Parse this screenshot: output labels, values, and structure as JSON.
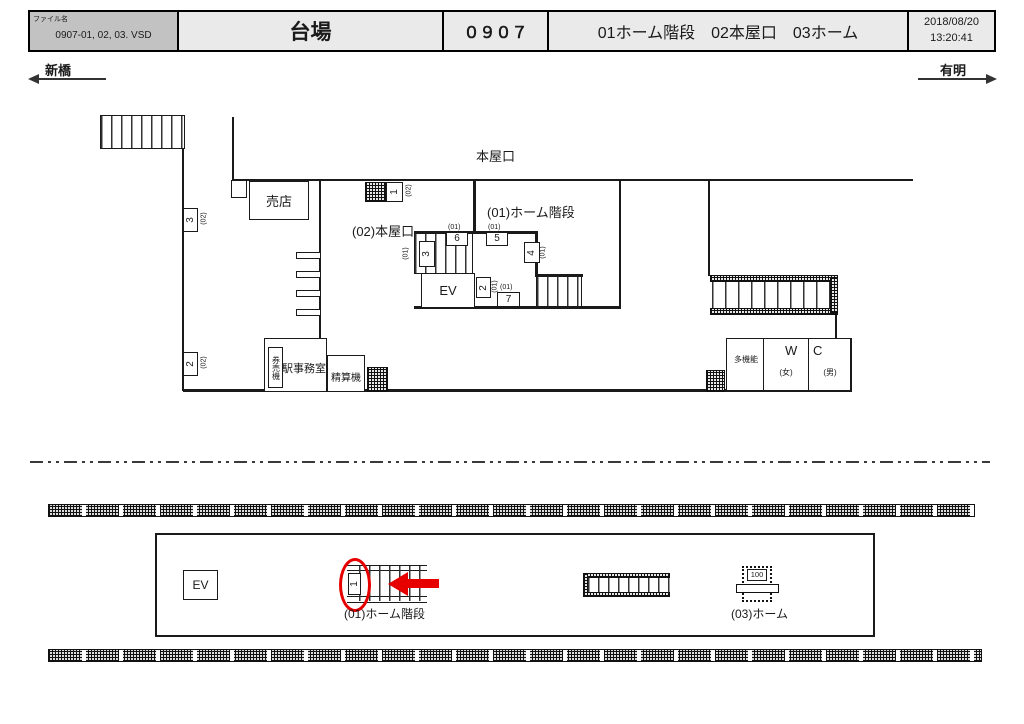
{
  "header": {
    "file_label": "ファイル名",
    "file_value": "0907-01, 02, 03. VSD",
    "station": "台場",
    "code": "０９０７",
    "subtitle": "01ホーム階段　02本屋口　03ホーム",
    "date": "2018/08/20",
    "time": "13:20:41"
  },
  "directions": {
    "left": "新橋",
    "right": "有明"
  },
  "concourse": {
    "honyaguchi": "本屋口",
    "baiten": "売店",
    "entrance02": "(02)本屋口",
    "stairs01": "(01)ホーム階段",
    "ev": "EV",
    "kenbaiki": "券売機",
    "office": "駅事務室",
    "seisanki": "精算機",
    "takinou": "多機能",
    "wc_w": "W",
    "wc_c": "C",
    "female": "(女)",
    "male": "(男)",
    "markers": {
      "m3_02": {
        "num": "3",
        "sub": "(02)"
      },
      "m2_02": {
        "num": "2",
        "sub": "(02)"
      },
      "m1_02": {
        "num": "1",
        "sub": "(02)"
      },
      "m3_01": {
        "num": "3",
        "sub": "(01)"
      },
      "m6_01": {
        "num": "6",
        "sub": "(01)"
      },
      "m5_01": {
        "num": "5",
        "sub": "(01)"
      },
      "m4_01": {
        "num": "4",
        "sub": "(01)"
      },
      "m2_01": {
        "num": "2",
        "sub": "(01)"
      },
      "m7_01": {
        "num": "7",
        "sub": "(01)"
      }
    }
  },
  "platform": {
    "ev": "EV",
    "marker1": "1",
    "stairs01": "(01)ホーム階段",
    "home03": "(03)ホーム",
    "sign_value": "100"
  },
  "colors": {
    "highlight_red": "#e60000",
    "header_file_cell_gray": "#c2c2c2",
    "header_cell_gray": "#eaeaea",
    "line": "#1a1a1a"
  }
}
